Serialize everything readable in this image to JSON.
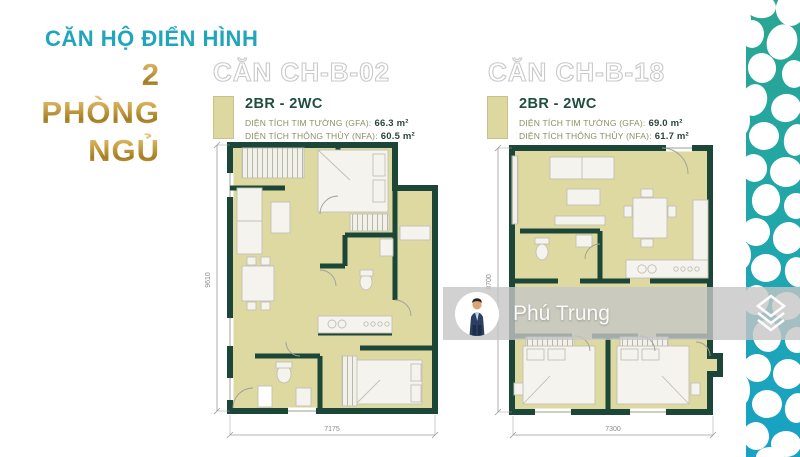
{
  "title": {
    "heading": "CĂN HỘ ĐIỂN HÌNH",
    "big_lines": [
      "2",
      "PHÒNG",
      "NGỦ"
    ]
  },
  "units": [
    {
      "name": "CĂN CH-B-02",
      "type": "2BR - 2WC",
      "gfa_label": "DIỆN TÍCH TIM TƯỜNG (GFA):",
      "gfa_value": "66.3 m²",
      "nfa_label": "DIỆN TÍCH THÔNG THỦY (NFA):",
      "nfa_value": "60.5 m²",
      "dim_width": "7175",
      "dim_height": "9610"
    },
    {
      "name": "CĂN CH-B-18",
      "type": "2BR - 2WC",
      "gfa_label": "DIỆN TÍCH TIM TƯỜNG (GFA):",
      "gfa_value": "69.0 m²",
      "nfa_label": "DIỆN TÍCH THÔNG THỦY (NFA):",
      "nfa_value": "61.7 m²",
      "dim_width": "7300",
      "dim_height": "8700"
    }
  ],
  "watermark": {
    "name": "Phú Trung"
  },
  "colors": {
    "accent_teal": "#1fa6bd",
    "gold": "#c49a3c",
    "floor_khaki": "#ddd9a1",
    "wall_green": "#1c4638",
    "pattern_teal_top": "#2aa691",
    "pattern_teal_bottom": "#17a2c6",
    "watermark_gray": "#c6c6c6"
  }
}
